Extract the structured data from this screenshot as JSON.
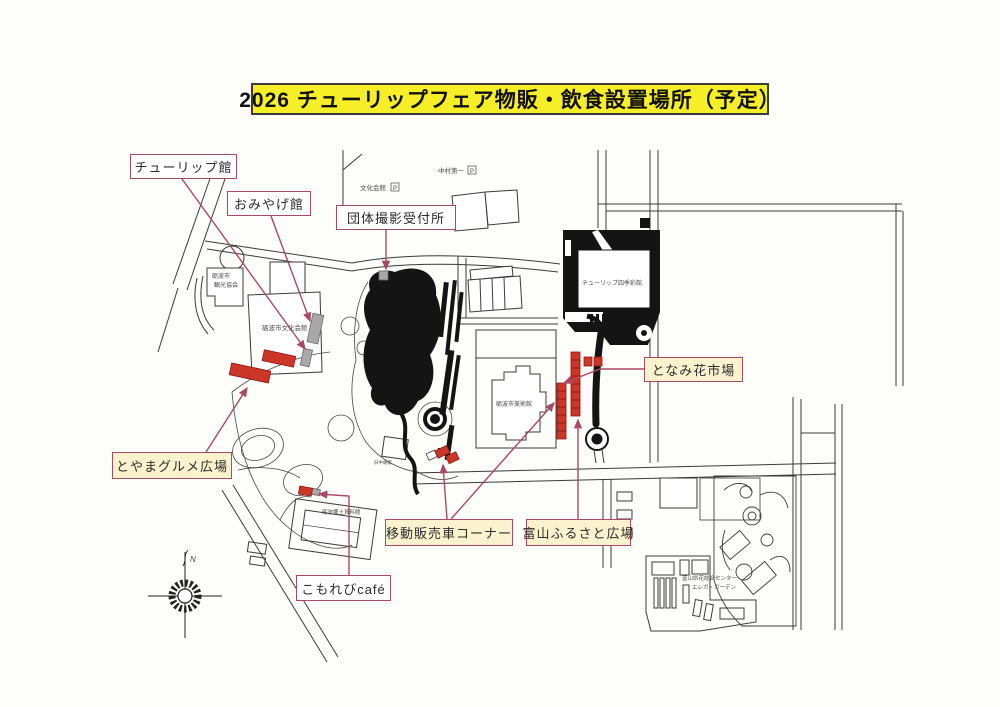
{
  "title": {
    "text": "2026 チューリップフェア物販・飲食設置場所（予定）"
  },
  "callouts": {
    "tulip_hall": {
      "label": "チューリップ館"
    },
    "souvenir_hall": {
      "label": "おみやげ館"
    },
    "group_photo_desk": {
      "label": "団体撮影受付所"
    },
    "tonami_flower_market": {
      "label": "となみ花市場"
    },
    "toyama_gourmet_plaza": {
      "label": "とやまグルメ広場"
    },
    "food_truck_corner": {
      "label": "移動販売車コーナー"
    },
    "toyama_furusato_plaza": {
      "label": "富山ふるさと広場"
    },
    "komorebi_cafe": {
      "label": "こもれびcafé"
    }
  },
  "map_labels": {
    "bunka_kaikan_parking": "文化会館",
    "nakamura_daiichi_parking": "中村第一",
    "parking_mark": "P",
    "kanko_kyokai_line1": "砺波市",
    "kanko_kyokai_line2": "観光協会",
    "bunka_kaikan": "砺波市文化会館",
    "shikisaikan": "チューリップ四季彩館",
    "art_museum": "砺波市美術館",
    "kyu_nakajima_house": "旧中嶋家",
    "kyodo_museum": "砺波郷土資料館",
    "flower_center_line1": "富山県花総合センター",
    "flower_center_line2": "エレガ・ガーデン",
    "compass_north": "N"
  },
  "colors": {
    "title_bg": "#f6ee26",
    "callout_border": "#a84a63",
    "callout_cream_bg": "#fcf2cd",
    "stall_red": "#cc3628",
    "facility_gray": "#a8a8a8",
    "map_ink": "#3a3a3a"
  }
}
